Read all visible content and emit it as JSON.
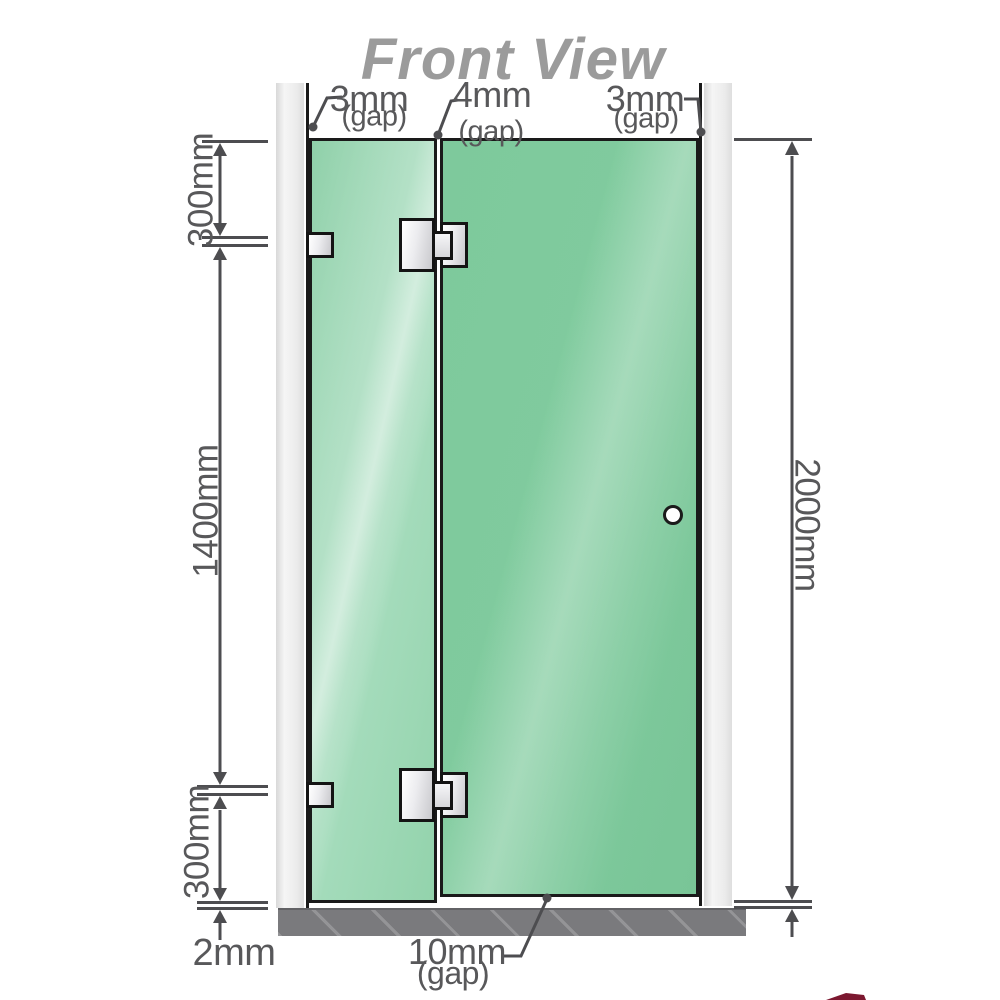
{
  "title": "Front View",
  "colors": {
    "glass_fixed": "#9bd6b2",
    "glass_door": "#80cb9e",
    "wall": "#ececec",
    "floor": "#7a7a7d",
    "dimension_line": "#4d4d50",
    "label_text": "#58585a",
    "title_text": "#9b9b9b",
    "hardware_fill": "#ececef",
    "outline": "#1a1a1a",
    "corner_watermark": "#7c1830"
  },
  "gaps_top": [
    {
      "value": "3mm",
      "unit": "(gap)"
    },
    {
      "value": "4mm",
      "unit": "(gap)"
    },
    {
      "value": "3mm",
      "unit": "(gap)"
    }
  ],
  "dimensions": {
    "left_top": "300mm",
    "left_middle": "1400mm",
    "left_bottom": "300mm",
    "right_total": "2000mm",
    "floor_clearance": "2mm",
    "bottom_gap_value": "10mm",
    "bottom_gap_unit": "(gap)"
  }
}
